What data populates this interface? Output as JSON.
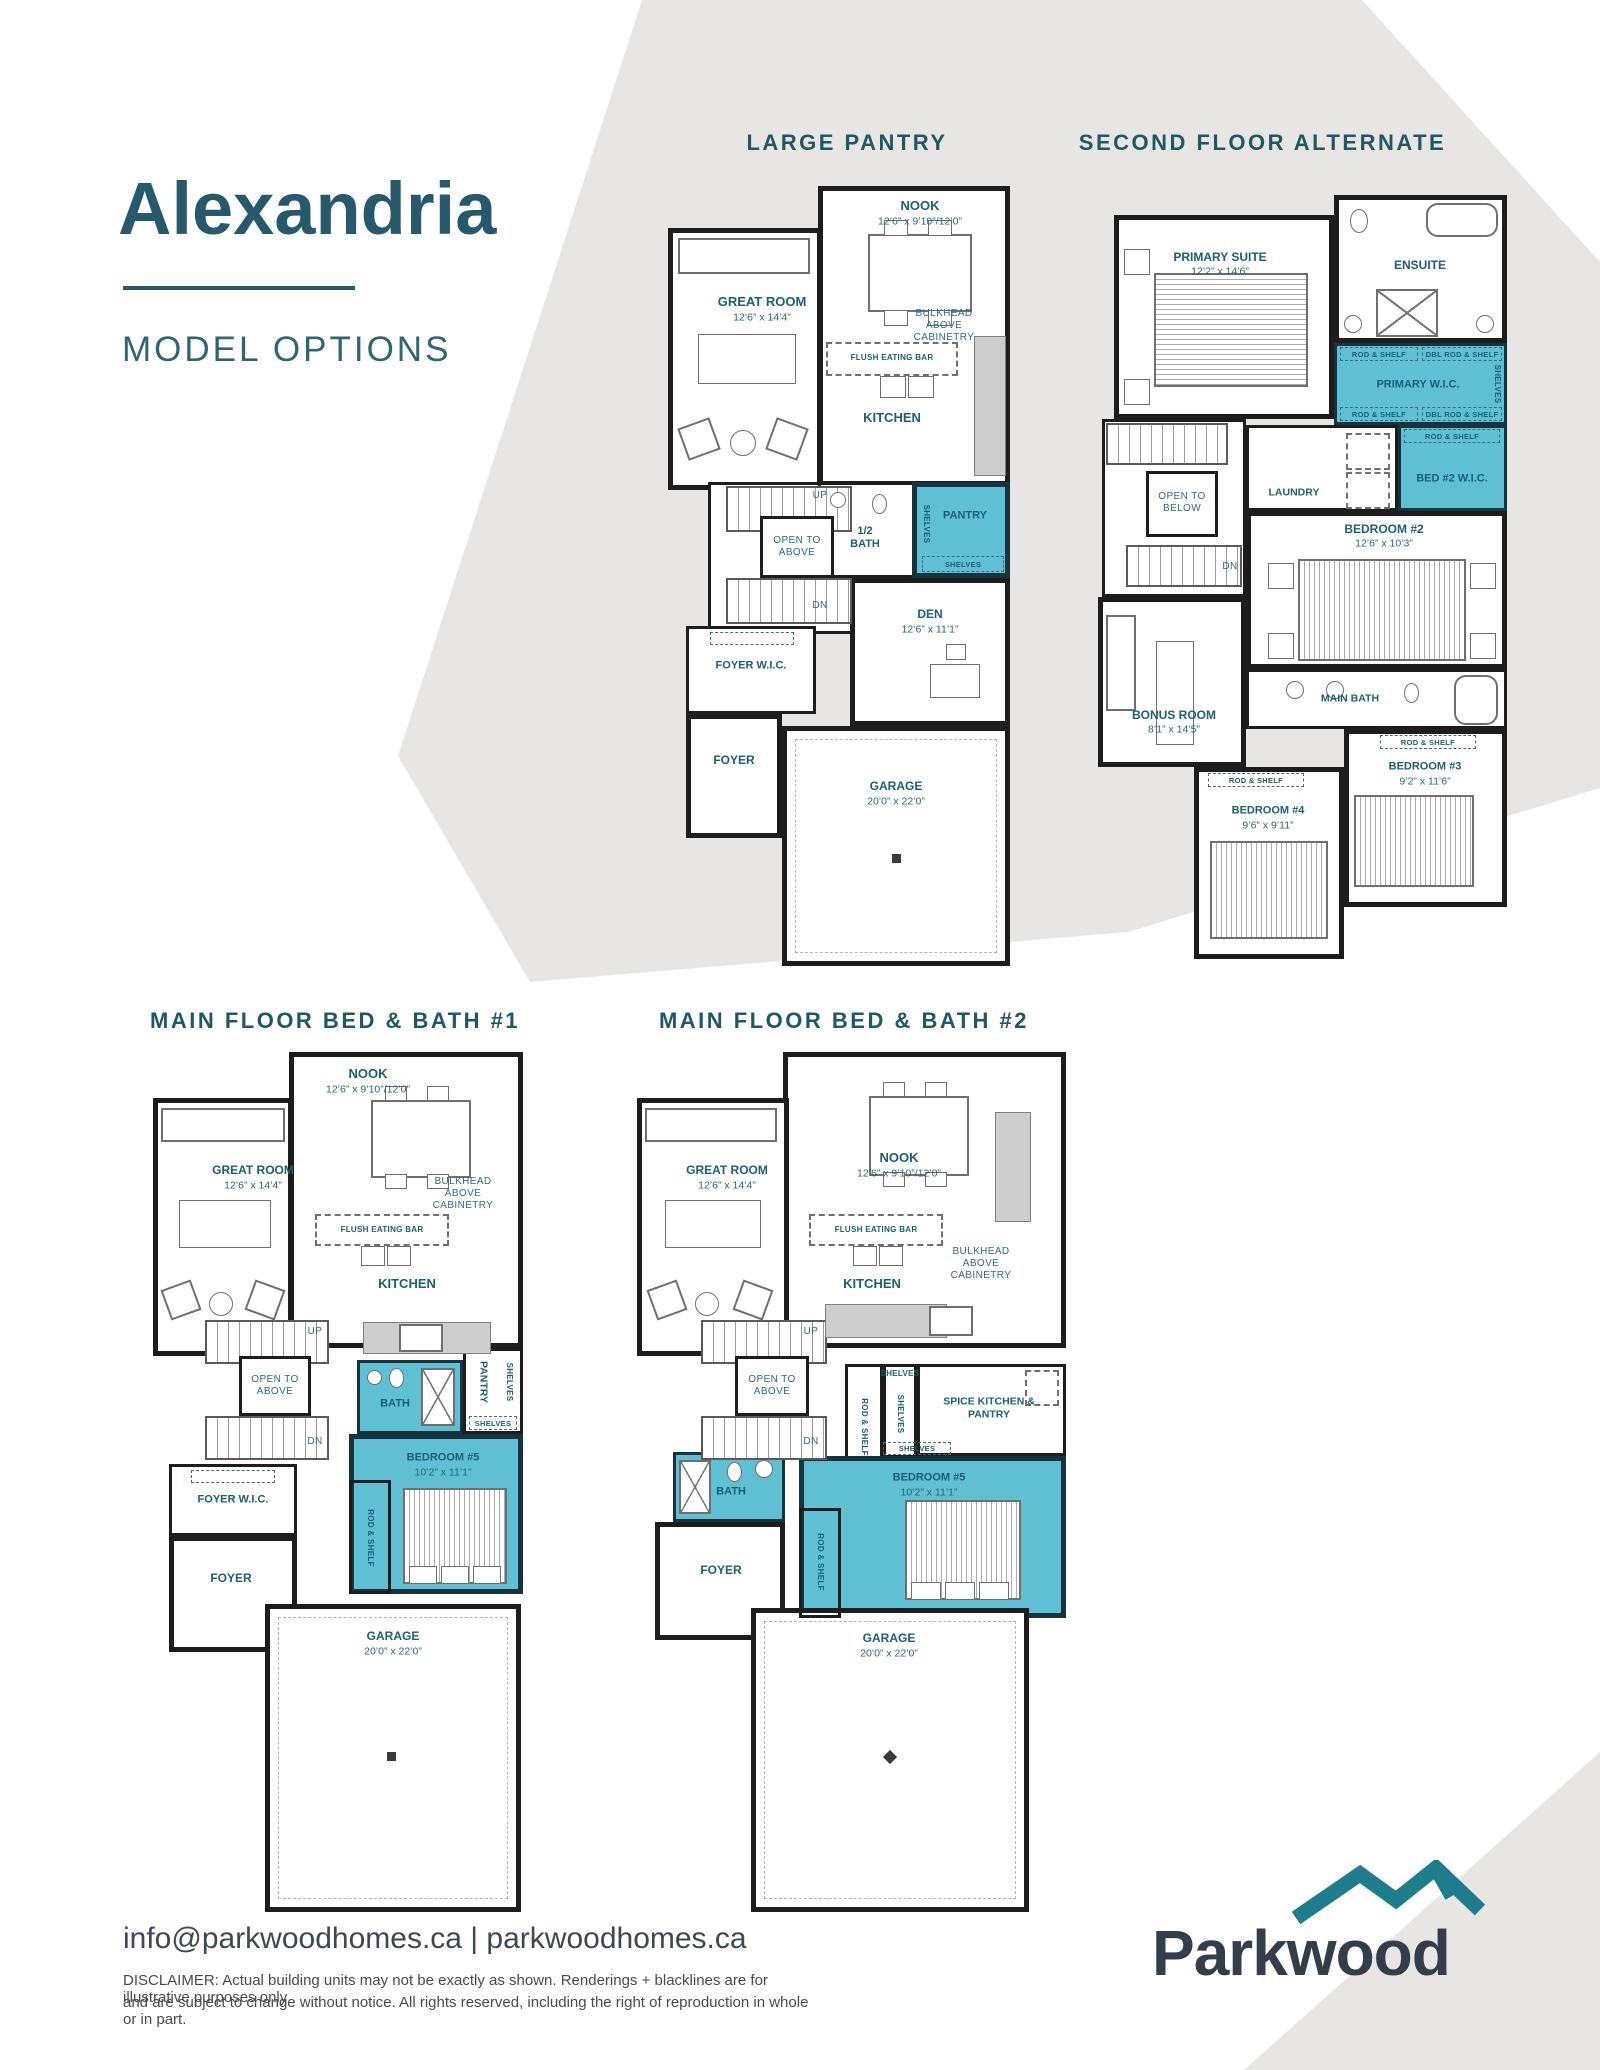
{
  "header": {
    "title": "Alexandria",
    "subtitle": "MODEL OPTIONS"
  },
  "footer": {
    "contact": "info@parkwoodhomes.ca  |  parkwoodhomes.ca",
    "disclaimer1": "DISCLAIMER: Actual building units may not be exactly as shown. Renderings + blacklines are for illustrative purposes only",
    "disclaimer2": "and are subject to change without notice. All rights reserved, including the right of reproduction in whole or in part.",
    "brand": "Parkwood"
  },
  "colors": {
    "accent_teal": "#1f5866",
    "highlight_fill": "#5fbfd3",
    "band_gray": "#e8e6e2",
    "logo_navy": "#333e4d",
    "logo_teal": "#1e7d8c"
  },
  "plans": {
    "p1": {
      "heading": "LARGE PANTRY",
      "nook": "NOOK",
      "nook_dim": "12’6” x 9’10”/12’0”",
      "great_room": "GREAT ROOM",
      "great_room_dim": "12’6” x 14’4”",
      "bulkhead": "BULKHEAD ABOVE CABINETRY",
      "flush_bar": "FLUSH EATING BAR",
      "kitchen": "KITCHEN",
      "up": "UP",
      "open_above": "OPEN TO ABOVE",
      "dn": "DN",
      "half_bath": "1/2 BATH",
      "pantry": "PANTRY",
      "shelves": "SHELVES",
      "den": "DEN",
      "den_dim": "12’6” x 11’1”",
      "foyer_wic": "FOYER W.I.C.",
      "foyer": "FOYER",
      "garage": "GARAGE",
      "garage_dim": "20’0” x 22’0”"
    },
    "p2": {
      "heading": "SECOND FLOOR ALTERNATE",
      "primary_suite": "PRIMARY SUITE",
      "primary_suite_dim": "12’2” x 14’6”",
      "ensuite": "ENSUITE",
      "rod_shelf": "ROD & SHELF",
      "dbl_rod_shelf": "DBL ROD & SHELF",
      "primary_wic": "PRIMARY W.I.C.",
      "shelves": "SHELVES",
      "bed2_wic": "BED #2 W.I.C.",
      "laundry": "LAUNDRY",
      "open_below": "OPEN TO BELOW",
      "dn": "DN",
      "bedroom2": "BEDROOM #2",
      "bedroom2_dim": "12’6” x 10’3”",
      "main_bath": "MAIN BATH",
      "bonus_room": "BONUS ROOM",
      "bonus_room_dim": "8’1” x 14’5”",
      "bedroom4": "BEDROOM #4",
      "bedroom4_dim": "9’6” x 9’11”",
      "bedroom3": "BEDROOM #3",
      "bedroom3_dim": "9’2” x 11’6”"
    },
    "p3": {
      "heading": "MAIN FLOOR BED & BATH #1",
      "nook": "NOOK",
      "nook_dim": "12’6” x 9’10”/12’0”",
      "great_room": "GREAT ROOM",
      "great_room_dim": "12’6” x 14’4”",
      "bulkhead": "BULKHEAD ABOVE CABINETRY",
      "flush_bar": "FLUSH EATING BAR",
      "kitchen": "KITCHEN",
      "up": "UP",
      "open_above": "OPEN TO ABOVE",
      "dn": "DN",
      "bath": "BATH",
      "pantry": "PANTRY",
      "shelves": "SHELVES",
      "bedroom5": "BEDROOM #5",
      "bedroom5_dim": "10’2” x 11’1”",
      "rod_shelf": "ROD & SHELF",
      "foyer_wic": "FOYER W.I.C.",
      "foyer": "FOYER",
      "garage": "GARAGE",
      "garage_dim": "20’0” x 22’0”"
    },
    "p4": {
      "heading": "MAIN FLOOR BED & BATH #2",
      "nook": "NOOK",
      "nook_dim": "12’6” x 9’10”/12’0”",
      "great_room": "GREAT ROOM",
      "great_room_dim": "12’6” x 14’4”",
      "bulkhead": "BULKHEAD ABOVE CABINETRY",
      "flush_bar": "FLUSH EATING BAR",
      "kitchen": "KITCHEN",
      "up": "UP",
      "open_above": "OPEN TO ABOVE",
      "dn": "DN",
      "bath": "BATH",
      "rod_shelf": "ROD & SHELF",
      "shelves": "SHELVES",
      "spice": "SPICE KITCHEN & PANTRY",
      "bedroom5": "BEDROOM #5",
      "bedroom5_dim": "10’2” x 11’1”",
      "foyer": "FOYER",
      "garage": "GARAGE",
      "garage_dim": "20’0” x 22’0”"
    }
  }
}
